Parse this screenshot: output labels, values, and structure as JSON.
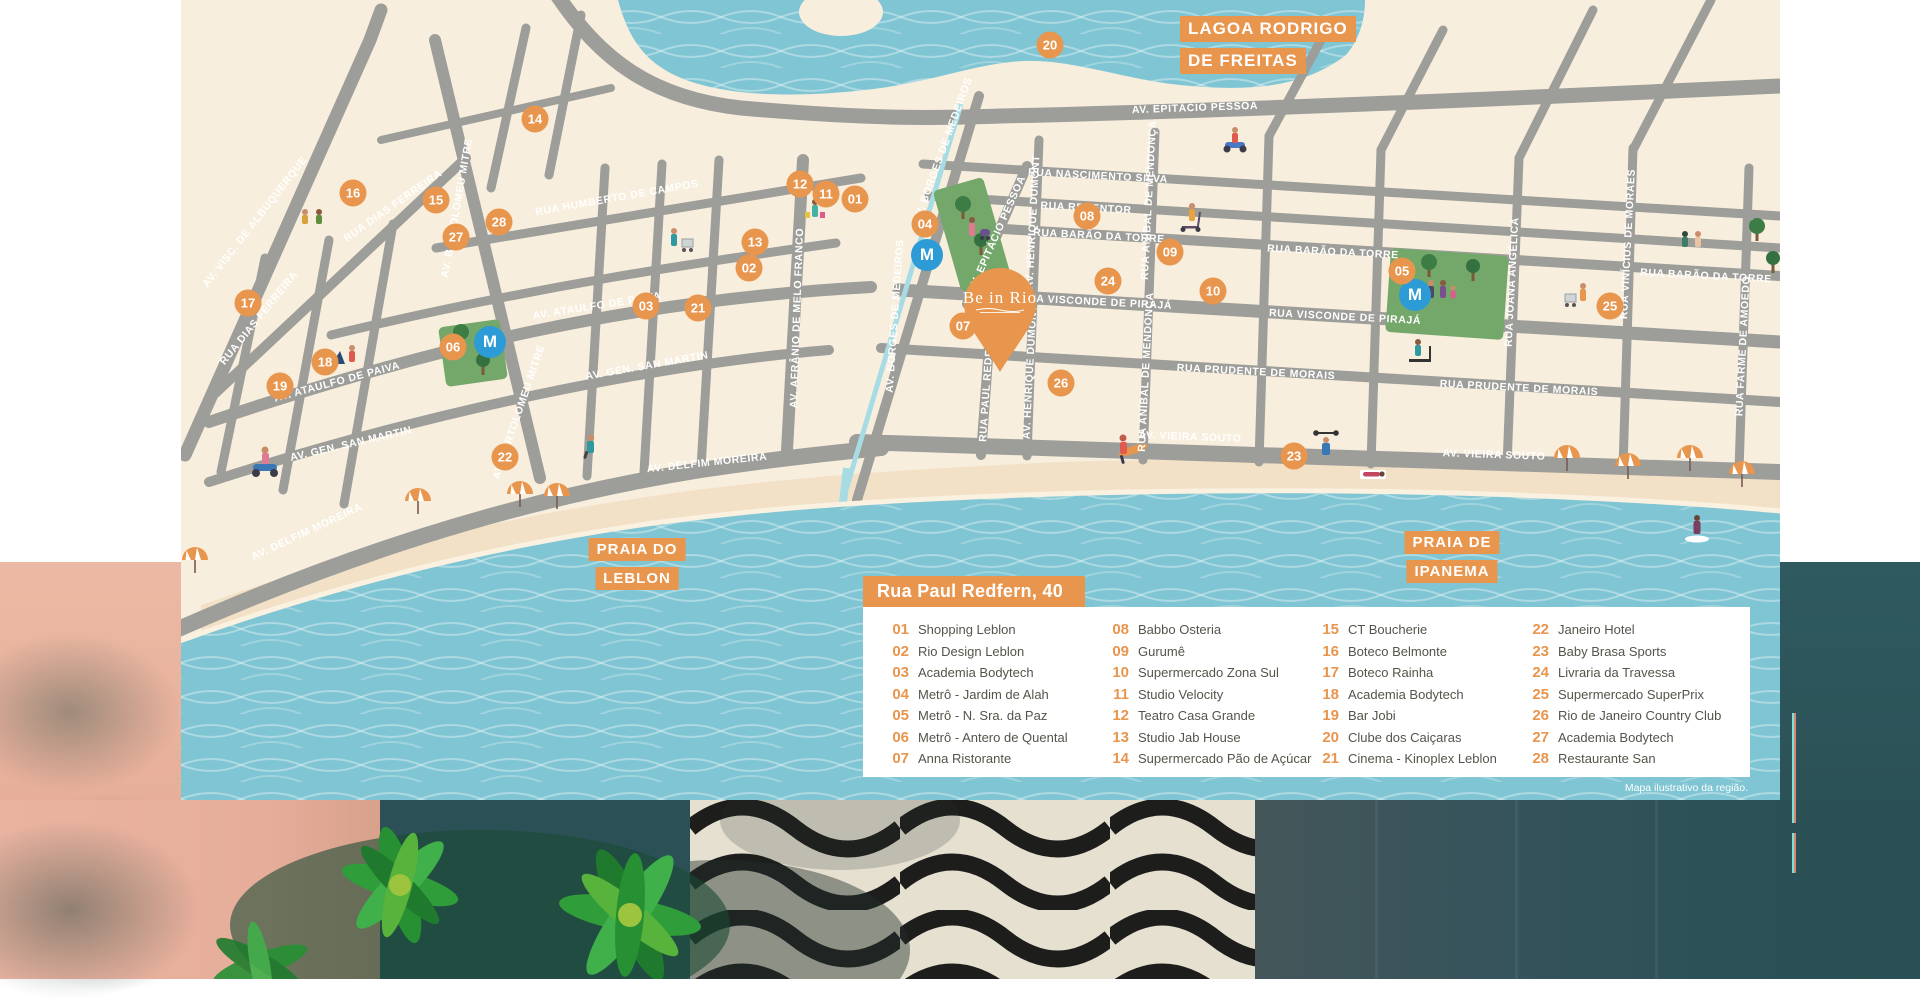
{
  "map": {
    "caption": "Mapa ilustrativo da região.",
    "pin": {
      "label": "Be in Rio"
    },
    "colors": {
      "accent": "#E8954D",
      "water": "#7FC5D3",
      "land": "#F8EEDD",
      "road": "#9D9D99",
      "park": "#74A76A",
      "metro_blue": "#2D9BD6",
      "sand": "#F3E1C7"
    },
    "area_labels": [
      {
        "id": "lagoa",
        "lines": [
          "LAGOA RODRIGO",
          "DE FREITAS"
        ],
        "x": 999,
        "y": 16,
        "size": "lg"
      },
      {
        "id": "leblon",
        "lines": [
          "PRAIA DO",
          "LEBLON"
        ],
        "x": 456,
        "y": 538,
        "size": "md"
      },
      {
        "id": "ipanema",
        "lines": [
          "PRAIA DE",
          "IPANEMA"
        ],
        "x": 1271,
        "y": 531,
        "size": "md"
      }
    ],
    "street_labels": [
      {
        "text": "AV. EPITÁCIO PESSOA",
        "x": 1014,
        "y": 108,
        "rot": -2
      },
      {
        "text": "AV. EPITÁCIO PESSOA",
        "x": 816,
        "y": 234,
        "rot": -66
      },
      {
        "text": "RUA NASCIMENTO SILVA",
        "x": 917,
        "y": 176,
        "rot": 3
      },
      {
        "text": "RUA REDENTOR",
        "x": 905,
        "y": 208,
        "rot": 3
      },
      {
        "text": "RUA BARÃO DA TORRE",
        "x": 918,
        "y": 236,
        "rot": 3
      },
      {
        "text": "RUA BARÃO DA TORRE",
        "x": 1152,
        "y": 252,
        "rot": 3
      },
      {
        "text": "RUA BARÃO DA TORRE",
        "x": 1525,
        "y": 276,
        "rot": 3
      },
      {
        "text": "RUA VISCONDE DE PIRAJÁ",
        "x": 915,
        "y": 302,
        "rot": 3
      },
      {
        "text": "RUA VISCONDE DE PIRAJÁ",
        "x": 1164,
        "y": 317,
        "rot": 3
      },
      {
        "text": "RUA PRUDENTE DE MORAIS",
        "x": 1075,
        "y": 372,
        "rot": 3
      },
      {
        "text": "RUA PRUDENTE DE MORAIS",
        "x": 1338,
        "y": 388,
        "rot": 3
      },
      {
        "text": "AV. VIEIRA SOUTO",
        "x": 1009,
        "y": 437,
        "rot": 2
      },
      {
        "text": "AV. VIEIRA SOUTO",
        "x": 1313,
        "y": 455,
        "rot": 2
      },
      {
        "text": "AV. HENRIQUE DUMONT",
        "x": 852,
        "y": 222,
        "rot": -87
      },
      {
        "text": "AV. HENRIQUE DUMONT",
        "x": 849,
        "y": 372,
        "rot": -87
      },
      {
        "text": "RUA ANÍBAL DE MENDONÇA",
        "x": 968,
        "y": 200,
        "rot": -87
      },
      {
        "text": "RUA ANÍBAL DE MENDONÇA",
        "x": 965,
        "y": 372,
        "rot": -87
      },
      {
        "text": "RUA JOANA ANGÉLICA",
        "x": 1331,
        "y": 282,
        "rot": -87
      },
      {
        "text": "RUA VINÍCIUS DE MORAES",
        "x": 1447,
        "y": 244,
        "rot": -87
      },
      {
        "text": "RUA FARME DE AMOEDO",
        "x": 1562,
        "y": 346,
        "rot": -87
      },
      {
        "text": "AV. BORGES DE MEDEIROS",
        "x": 762,
        "y": 150,
        "rot": -70
      },
      {
        "text": "AV. BORGES DE MEDEIROS",
        "x": 714,
        "y": 316,
        "rot": -86
      },
      {
        "text": "AV. AFRÂNIO DE MELO FRANCO",
        "x": 616,
        "y": 318,
        "rot": -88
      },
      {
        "text": "RUA PAUL REDFERN",
        "x": 806,
        "y": 384,
        "rot": -86
      },
      {
        "text": "AV. VISC. DE ALBUQUERQUE",
        "x": 74,
        "y": 222,
        "rot": -52
      },
      {
        "text": "RUA DIAS FERREIRA",
        "x": 212,
        "y": 206,
        "rot": -35
      },
      {
        "text": "RUA DIAS FERREIRA",
        "x": 78,
        "y": 318,
        "rot": -51
      },
      {
        "text": "AV. BARTOLOMEU MITRE",
        "x": 276,
        "y": 208,
        "rot": -80
      },
      {
        "text": "AV. BARTOLOMEU MITRE",
        "x": 338,
        "y": 412,
        "rot": -71
      },
      {
        "text": "RUA HUMBERTO DE CAMPOS",
        "x": 436,
        "y": 198,
        "rot": -10
      },
      {
        "text": "AV. ATAULFO DE PAIVA",
        "x": 156,
        "y": 382,
        "rot": -15
      },
      {
        "text": "AV. ATAULFO DE PAIVA",
        "x": 416,
        "y": 306,
        "rot": -9
      },
      {
        "text": "AV. GEN. SAN MARTIN",
        "x": 170,
        "y": 444,
        "rot": -13
      },
      {
        "text": "AV. GEN. SAN MARTIN",
        "x": 466,
        "y": 366,
        "rot": -10
      },
      {
        "text": "AV. DELFIM MOREIRA",
        "x": 126,
        "y": 532,
        "rot": -25
      },
      {
        "text": "AV. DELFIM MOREIRA",
        "x": 526,
        "y": 463,
        "rot": -6
      }
    ],
    "markers": [
      {
        "n": "01",
        "x": 674,
        "y": 199
      },
      {
        "n": "02",
        "x": 568,
        "y": 268
      },
      {
        "n": "03",
        "x": 465,
        "y": 306
      },
      {
        "n": "04",
        "x": 744,
        "y": 224
      },
      {
        "n": "05",
        "x": 1221,
        "y": 271
      },
      {
        "n": "06",
        "x": 272,
        "y": 347
      },
      {
        "n": "07",
        "x": 782,
        "y": 326
      },
      {
        "n": "08",
        "x": 906,
        "y": 216
      },
      {
        "n": "09",
        "x": 989,
        "y": 252
      },
      {
        "n": "10",
        "x": 1032,
        "y": 291
      },
      {
        "n": "11",
        "x": 645,
        "y": 194
      },
      {
        "n": "12",
        "x": 619,
        "y": 184
      },
      {
        "n": "13",
        "x": 574,
        "y": 242
      },
      {
        "n": "14",
        "x": 354,
        "y": 119
      },
      {
        "n": "15",
        "x": 255,
        "y": 200
      },
      {
        "n": "16",
        "x": 172,
        "y": 193
      },
      {
        "n": "17",
        "x": 67,
        "y": 303
      },
      {
        "n": "18",
        "x": 144,
        "y": 362
      },
      {
        "n": "19",
        "x": 99,
        "y": 386
      },
      {
        "n": "20",
        "x": 869,
        "y": 45
      },
      {
        "n": "21",
        "x": 517,
        "y": 308
      },
      {
        "n": "22",
        "x": 324,
        "y": 457
      },
      {
        "n": "23",
        "x": 1113,
        "y": 456
      },
      {
        "n": "24",
        "x": 927,
        "y": 281
      },
      {
        "n": "25",
        "x": 1429,
        "y": 306
      },
      {
        "n": "26",
        "x": 880,
        "y": 383
      },
      {
        "n": "27",
        "x": 275,
        "y": 237
      },
      {
        "n": "28",
        "x": 318,
        "y": 222
      }
    ],
    "metro_stations": [
      {
        "x": 309,
        "y": 342
      },
      {
        "x": 746,
        "y": 255
      },
      {
        "x": 1234,
        "y": 295
      }
    ],
    "metro_letter": "M",
    "umbrellas": [
      {
        "x": 14,
        "y": 578
      },
      {
        "x": 237,
        "y": 519
      },
      {
        "x": 339,
        "y": 512
      },
      {
        "x": 376,
        "y": 514
      },
      {
        "x": 1386,
        "y": 476
      },
      {
        "x": 1447,
        "y": 484
      },
      {
        "x": 1509,
        "y": 476
      },
      {
        "x": 1561,
        "y": 492
      }
    ],
    "legend": {
      "title": "Rua Paul Redfern, 40",
      "items": [
        {
          "n": "01",
          "label": "Shopping Leblon"
        },
        {
          "n": "02",
          "label": "Rio Design Leblon"
        },
        {
          "n": "03",
          "label": "Academia Bodytech"
        },
        {
          "n": "04",
          "label": "Metrô - Jardim de Alah"
        },
        {
          "n": "05",
          "label": "Metrô - N. Sra. da Paz"
        },
        {
          "n": "06",
          "label": "Metrô - Antero de Quental"
        },
        {
          "n": "07",
          "label": "Anna Ristorante"
        },
        {
          "n": "08",
          "label": "Babbo Osteria"
        },
        {
          "n": "09",
          "label": "Gurumê"
        },
        {
          "n": "10",
          "label": "Supermercado Zona Sul"
        },
        {
          "n": "11",
          "label": "Studio Velocity"
        },
        {
          "n": "12",
          "label": "Teatro Casa Grande"
        },
        {
          "n": "13",
          "label": "Studio Jab House"
        },
        {
          "n": "14",
          "label": "Supermercado Pão de Açúcar"
        },
        {
          "n": "15",
          "label": "CT Boucherie"
        },
        {
          "n": "16",
          "label": "Boteco Belmonte"
        },
        {
          "n": "17",
          "label": "Boteco Rainha"
        },
        {
          "n": "18",
          "label": "Academia Bodytech"
        },
        {
          "n": "19",
          "label": "Bar Jobi"
        },
        {
          "n": "20",
          "label": "Clube dos Caiçaras"
        },
        {
          "n": "21",
          "label": "Cinema - Kinoplex Leblon"
        },
        {
          "n": "22",
          "label": "Janeiro Hotel"
        },
        {
          "n": "23",
          "label": "Baby Brasa Sports"
        },
        {
          "n": "24",
          "label": "Livraria da Travessa"
        },
        {
          "n": "25",
          "label": "Supermercado SuperPrix"
        },
        {
          "n": "26",
          "label": "Rio de Janeiro Country Club"
        },
        {
          "n": "27",
          "label": "Academia Bodytech"
        },
        {
          "n": "28",
          "label": "Restaurante San"
        }
      ]
    }
  }
}
